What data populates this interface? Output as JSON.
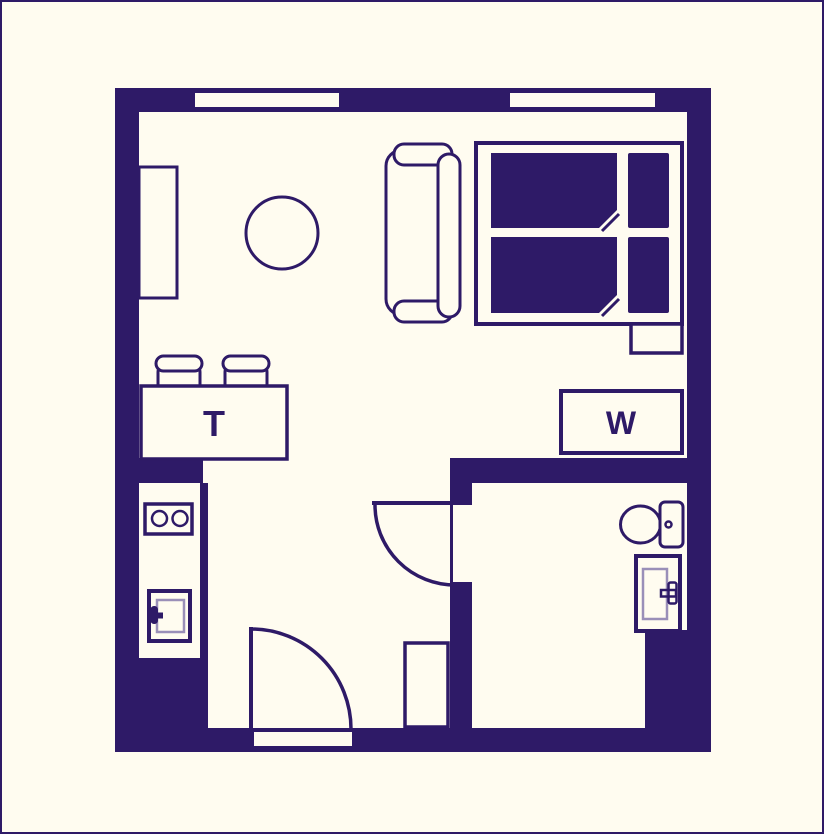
{
  "canvas": {
    "width": 824,
    "height": 834
  },
  "colors": {
    "wall_purple": "#2E1A67",
    "floor_cream": "#FFFCF0",
    "appliance_liner": "#9A8FB8"
  },
  "labels": {
    "dining_table": "T",
    "washing_machine": "W"
  },
  "plan": {
    "type": "studio-apartment-floor-plan",
    "rooms": [
      {
        "name": "living-sleeping-area"
      },
      {
        "name": "kitchen-nook"
      },
      {
        "name": "hallway"
      },
      {
        "name": "bathroom"
      }
    ],
    "furniture": [
      {
        "name": "wardrobe"
      },
      {
        "name": "round-table"
      },
      {
        "name": "sofa"
      },
      {
        "name": "double-bed",
        "parts": [
          "duvet-top",
          "duvet-bottom",
          "pillow-top",
          "pillow-bottom",
          "nightstand"
        ]
      },
      {
        "name": "dining-table",
        "label": "T"
      },
      {
        "name": "stool",
        "count": 2
      },
      {
        "name": "washing-machine",
        "label": "W"
      },
      {
        "name": "stove",
        "burners": 2
      },
      {
        "name": "kitchen-appliance"
      },
      {
        "name": "toilet"
      },
      {
        "name": "bathroom-sink"
      },
      {
        "name": "hall-cabinet"
      }
    ],
    "openings": [
      {
        "name": "window-left"
      },
      {
        "name": "window-right"
      },
      {
        "name": "entry-door"
      },
      {
        "name": "bathroom-door"
      }
    ]
  }
}
